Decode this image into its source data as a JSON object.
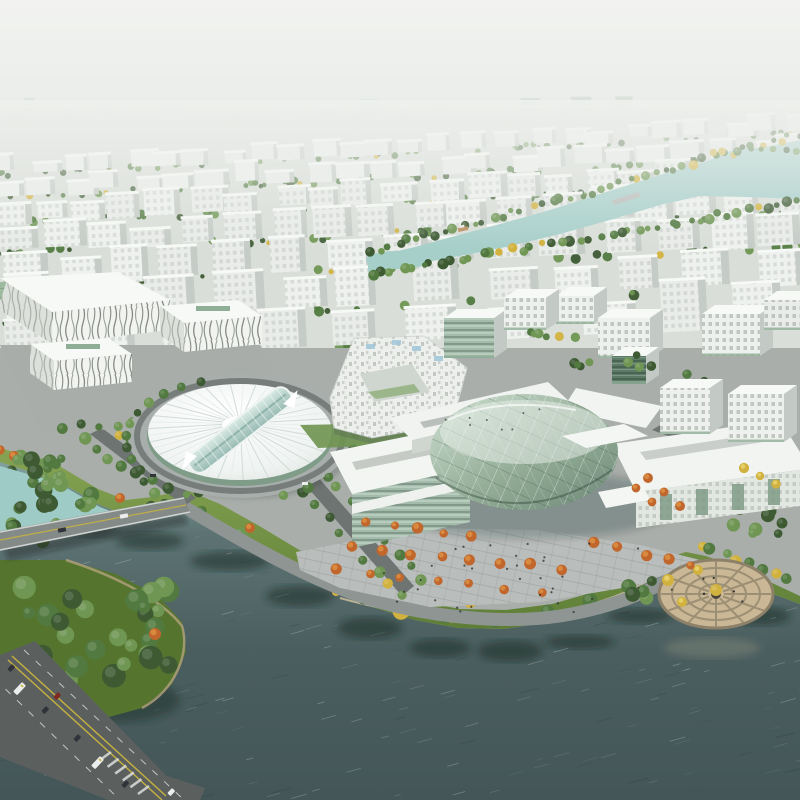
{
  "scene": {
    "type": "architectural-aerial-render",
    "description": "Hazy daytime bird's-eye rendering of a riverside masterplan: grids of white mid-rise blocks recede to a foggy horizon, a light-teal canal winds between tree rows, and a landmark campus with a ribbed white oval hall and a round glass cultural centre sits on a landscaped waterfront with autumn trees, a road bridge, a highway with buses, and a circular lakeside plaza beside dark teal water.",
    "time_of_day": "hazy-day",
    "landmarks": {
      "sky": "hazy white sky and distant city",
      "block_grid": "receding rows of white office blocks with tree lines",
      "canal": "light teal canal with wooded banks and small boat",
      "expo_hall": "white expo hall with green skylight and zebra-striped facades",
      "oval_hall": "white ribbed oval dome hall with glass spine",
      "courtyard_building": "white pixel-facade courtyard building",
      "cultural_centre": "round green glass drum with white slab wings",
      "office_park": "white perforated office cubes with green glass",
      "waterfront": "curved lawn bank with green, orange and yellow trees",
      "bridge": "road bridge crossing the river",
      "highway": "diagonal multi-lane road with buses and cars",
      "circular_plaza": "round tan plaza with radial paving at the water edge",
      "bay": "dark teal rippled water with tree reflections"
    }
  },
  "palette": {
    "sky_top": "#f2f3f0",
    "sky_low": "#e2e6e3",
    "haze": "#eceeeb",
    "far_ground": "#d9ded8",
    "block_front": "#eef1ee",
    "block_side": "#c5cbc6",
    "block_top": "#f7f9f6",
    "tree_dark": "#3d5a33",
    "tree_mid": "#527a40",
    "tree_light": "#6f9653",
    "tree_orange": "#c1662c",
    "tree_orange_hi": "#d88a3f",
    "tree_yellow": "#d2b23e",
    "canal_water": "#a6cfca",
    "pool_water": "#9ecbc6",
    "water_deep": "#4b5e5f",
    "campus_ground": "#a9aeab",
    "plaza_paving": "#b9bdbb",
    "road_light": "#8f9593",
    "road_mid": "#6e7472",
    "asphalt": "#5b605f",
    "lane_yellow": "#c7b23f",
    "lane_white": "#dcdedb",
    "lawn": "#7c9c4a",
    "lawn_dark": "#5e7e37",
    "grass_dark": "#55752f",
    "glass_green": "#a3bbaa",
    "glass_dark": "#5d7a66",
    "dome_white": "#fafcfb",
    "rib_grey": "#cdd8d2",
    "plaza_tan": "#c9b795",
    "plaza_tan_line": "#9d8f74",
    "bridge_deck": "#848a88",
    "sand_edge": "#b3a27d",
    "people": "#2e3330",
    "vehicle_dark": "#30343a",
    "vehicle_white": "#eceded"
  }
}
